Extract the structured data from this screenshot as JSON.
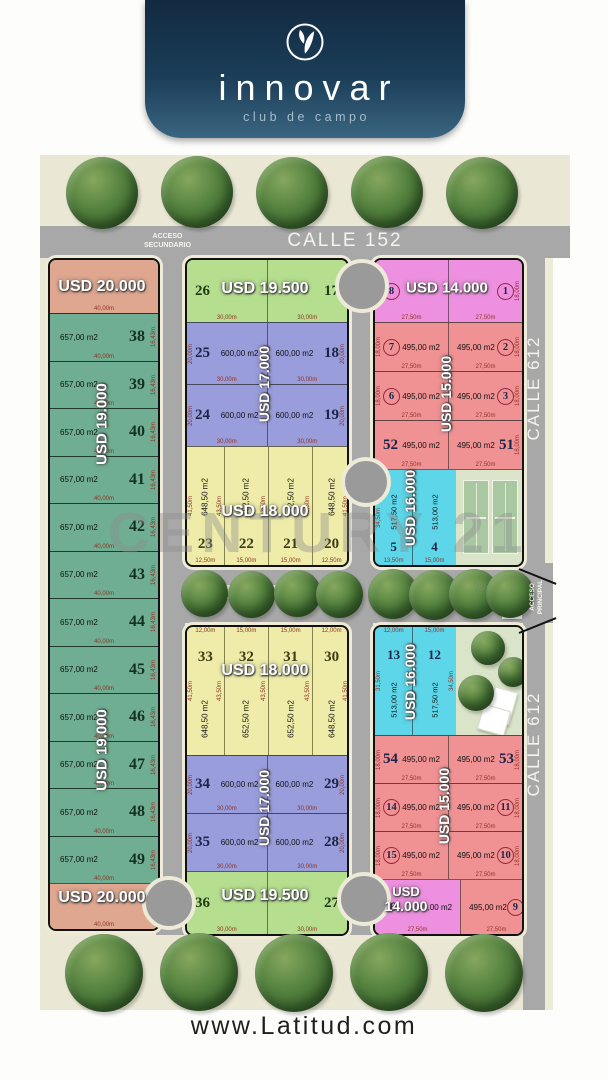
{
  "brand": {
    "logo_name": "innovar",
    "logo_tagline": "club de campo"
  },
  "footer": {
    "website": "www.Latitud.com"
  },
  "watermark": {
    "text": "CENTURY 21",
    "registered": "®"
  },
  "streets": {
    "calle152": "CALLE 152",
    "acceso_secundario_l1": "ACCESO",
    "acceso_secundario_l2": "SECUNDARIO",
    "calle612_upper": "CALLE 612",
    "calle612_lower": "CALLE 612",
    "acceso_principal_l1": "ACCESO",
    "acceso_principal_l2": "PRINCIPAL"
  },
  "palette": {
    "badge_navy": "#1b3d58",
    "map_beige": "#eae7d5",
    "street_gray": "#a8a8a8",
    "lot_green": "#6fae92",
    "lot_salmon": "#dfa78f",
    "lot_light_green": "#b5df8e",
    "lot_blue": "#9a9ddb",
    "lot_yellow": "#eeeca8",
    "lot_pink": "#ee90e0",
    "lot_red": "#f09294",
    "lot_cyan": "#5cd6e8",
    "courts_green": "#d9e4c8"
  },
  "left_block": {
    "price_top": "USD 20.000",
    "price_bottom": "USD 20.000",
    "price_mid_1": "USD 19.000",
    "price_mid_2": "USD 19.000",
    "area": "657,00 m2",
    "width": "40,00m",
    "depth": "16,43m",
    "lots": [
      "38",
      "39",
      "40",
      "41",
      "42",
      "43",
      "44",
      "45",
      "46",
      "47",
      "48",
      "49"
    ]
  },
  "mid_top": {
    "green": {
      "left_num": "26",
      "right_num": "17",
      "price": "USD 19.500",
      "dim": "30,00m"
    },
    "blue": {
      "price": "USD 17.000",
      "area": "600,00 m2",
      "dim_w": "30,00m",
      "dim_d": "20,00m",
      "rows": [
        [
          "25",
          "18"
        ],
        [
          "24",
          "19"
        ]
      ]
    },
    "yellow": {
      "price": "USD 18.000",
      "nums": [
        "23",
        "22",
        "21",
        "20"
      ],
      "areas": [
        "648,50 m2",
        "652,50 m2",
        "652,50 m2",
        "648,50 m2"
      ],
      "widths": [
        "12,50m",
        "15,00m",
        "15,00m",
        "12,50m"
      ],
      "depth_outer": "41,50m",
      "depth_inner": "43,50m"
    }
  },
  "mid_bottom": {
    "yellow": {
      "price": "USD 18.000",
      "nums": [
        "33",
        "32",
        "31",
        "30"
      ],
      "areas": [
        "648,50 m2",
        "652,50 m2",
        "652,50 m2",
        "648,50 m2"
      ],
      "widths": [
        "12,00m",
        "15,00m",
        "15,00m",
        "12,00m"
      ],
      "depth_outer": "41,50m",
      "depth_inner": "43,50m"
    },
    "blue": {
      "price": "USD 17.000",
      "area": "600,00 m2",
      "dim_w": "30,00m",
      "dim_d": "20,00m",
      "rows": [
        [
          "34",
          "29"
        ],
        [
          "35",
          "28"
        ]
      ]
    },
    "green": {
      "left_num": "36",
      "right_num": "27",
      "price": "USD 19.500",
      "dim": "30,00m"
    }
  },
  "right_top": {
    "pink": {
      "left_num": "8",
      "right_num": "1",
      "price": "USD 14.000",
      "dim": "27,50m",
      "depth": "18,00m"
    },
    "red": {
      "price": "USD 15.000",
      "area": "495,00 m2",
      "dim": "27,50m",
      "depth": "18,00m",
      "rows": [
        [
          "7",
          "2"
        ],
        [
          "6",
          "3"
        ],
        [
          "52",
          "51"
        ]
      ]
    },
    "cyan": {
      "price": "USD 16.000",
      "left_num": "5",
      "left_area": "517,50 m2",
      "left_w": "13,50m",
      "right_num": "4",
      "right_area": "513,00 m2",
      "right_w": "15,00m",
      "depth": "34,50m"
    }
  },
  "right_bottom": {
    "cyan": {
      "price": "USD 16.000",
      "left_num": "13",
      "left_area": "513,00 m2",
      "left_w": "12,00m",
      "right_num": "12",
      "right_area": "517,50 m2",
      "right_w": "15,00m",
      "depth_left": "31,50m",
      "depth_right": "34,50m"
    },
    "red": {
      "price": "USD 15.000",
      "area": "495,00 m2",
      "dim": "27,50m",
      "depth": "18,00m",
      "rows": [
        [
          "54",
          "53"
        ],
        [
          "14",
          "11"
        ],
        [
          "15",
          "10"
        ]
      ]
    },
    "pink": {
      "num": "16",
      "area": "495,00 m2",
      "price_line1": "USD",
      "price_line2": "14.000",
      "dim": "27,50m"
    },
    "red_last": {
      "num": "9",
      "area": "495,00 m2",
      "dim": "27,50m"
    }
  }
}
